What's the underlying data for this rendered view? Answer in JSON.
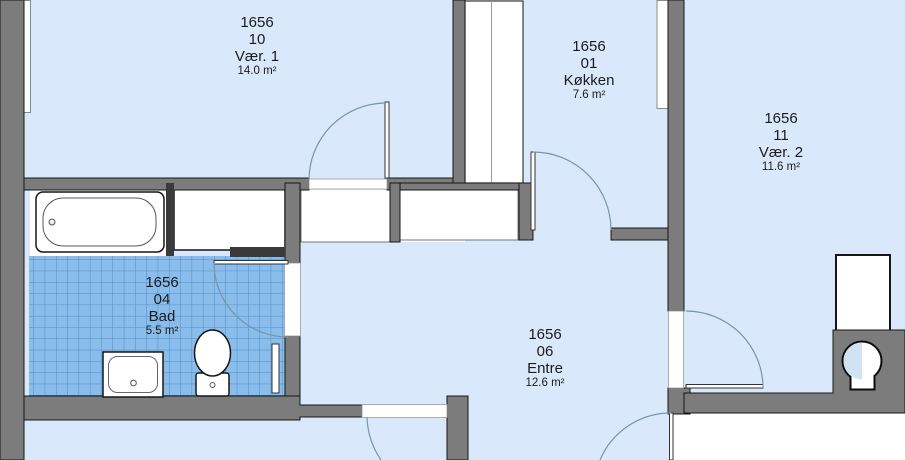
{
  "plan": {
    "rooms": [
      {
        "unit": "1656",
        "number": "10",
        "name": "Vær. 1",
        "area": "14.0 m²"
      },
      {
        "unit": "1656",
        "number": "01",
        "name": "Køkken",
        "area": "7.6 m²"
      },
      {
        "unit": "1656",
        "number": "11",
        "name": "Vær. 2",
        "area": "11.6 m²"
      },
      {
        "unit": "1656",
        "number": "04",
        "name": "Bad",
        "area": "5.5 m²"
      },
      {
        "unit": "1656",
        "number": "06",
        "name": "Entre",
        "area": "12.6 m²"
      }
    ],
    "fixtures": [
      "bathtub",
      "sink",
      "toilet",
      "radiator",
      "vent-shaft",
      "wardrobe",
      "cabinet",
      "cupboard"
    ],
    "colors": {
      "room_fill": "#d9e9fb",
      "tile_fill": "#8abdeb",
      "tile_line": "#4d8fc7",
      "wall_fill": "#7c7c7c",
      "outline": "#161616",
      "door_arc": "#7795a8"
    }
  }
}
